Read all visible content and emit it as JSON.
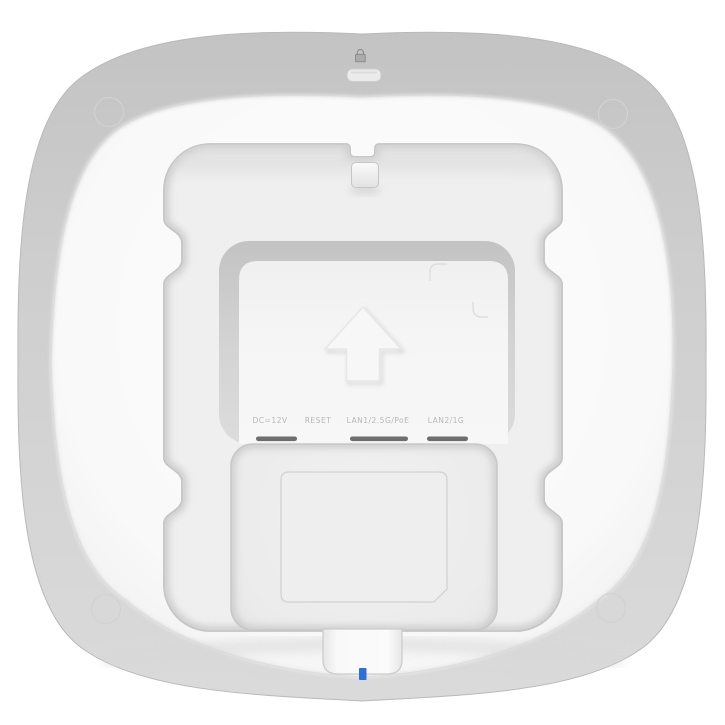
{
  "product": {
    "description": "Rear view of a white square wireless access point",
    "port_labels": {
      "dc": "DC=12V",
      "reset": "RESET",
      "lan1": "LAN1/2.5G/PoE",
      "lan2": "LAN2/1G"
    },
    "led_color": "#2f6fd9",
    "icons": {
      "top_center": "lock-icon",
      "plate_center": "up-arrow-icon"
    },
    "colors": {
      "shell_rim": "#cdcdcd",
      "face": "#fafafa",
      "recess": "#efefef",
      "label_text": "#b7b7b9",
      "port_slot": "#6e6e6e"
    }
  }
}
